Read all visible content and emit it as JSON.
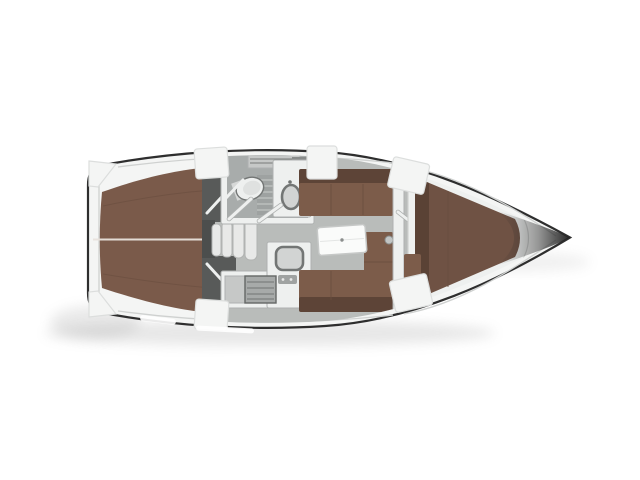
{
  "figure": {
    "type": "floorplan",
    "subject": "sailing-yacht-interior-top-view",
    "orientation": {
      "bow": "right",
      "stern": "left"
    },
    "regions": [
      "cockpit-teak-sole",
      "companionway-steps",
      "aft-lockers",
      "head-compartment",
      "galley",
      "saloon",
      "forward-v-berth-cabin",
      "bow"
    ],
    "fixtures": [
      "toilet",
      "shower-grate",
      "washbasin",
      "vanity-shelf",
      "galley-sink",
      "stove",
      "saloon-table",
      "settee-port",
      "settee-starboard-l-shape",
      "bulkhead-door",
      "v-berth-mattress"
    ]
  },
  "colors": {
    "background": "#ffffff",
    "outline": "#2e2e2e",
    "deck": "#f4f5f4",
    "deck_shade": "#dcdedd",
    "inner_line": "#cfd1d0",
    "teak": "#7a5a4a",
    "teak_dark": "#684c3e",
    "teak_light_line": "#e9e3dd",
    "floor": "#b9bcba",
    "head_floor": "#a8acab",
    "grate": "#9ea2a1",
    "grate_stripe": "#bcbfbe",
    "fixture": "#eef0ef",
    "fixture_edge": "#aeb1b0",
    "basin": "#d2d4d3",
    "basin_rim": "#737675",
    "well_dark": "#585a59",
    "well_deep": "#4c4e4d",
    "step": "#e8e9e8",
    "step_edge": "#b1b3b2",
    "seat": "#7c5c4a",
    "seat_dark": "#5d4437",
    "seat_seam": "#6b4f40",
    "table": "#fafbfa",
    "table_edge": "#c6c8c7",
    "counter": "#c6c8c7",
    "stove": "#a7aaa9",
    "stove_line": "#646766",
    "white_block": "#f4f5f4",
    "vberth": "#6f5244",
    "vberth_dark": "#573f33",
    "bow_dark": "#242424",
    "shadow": "#8a8a8a"
  }
}
